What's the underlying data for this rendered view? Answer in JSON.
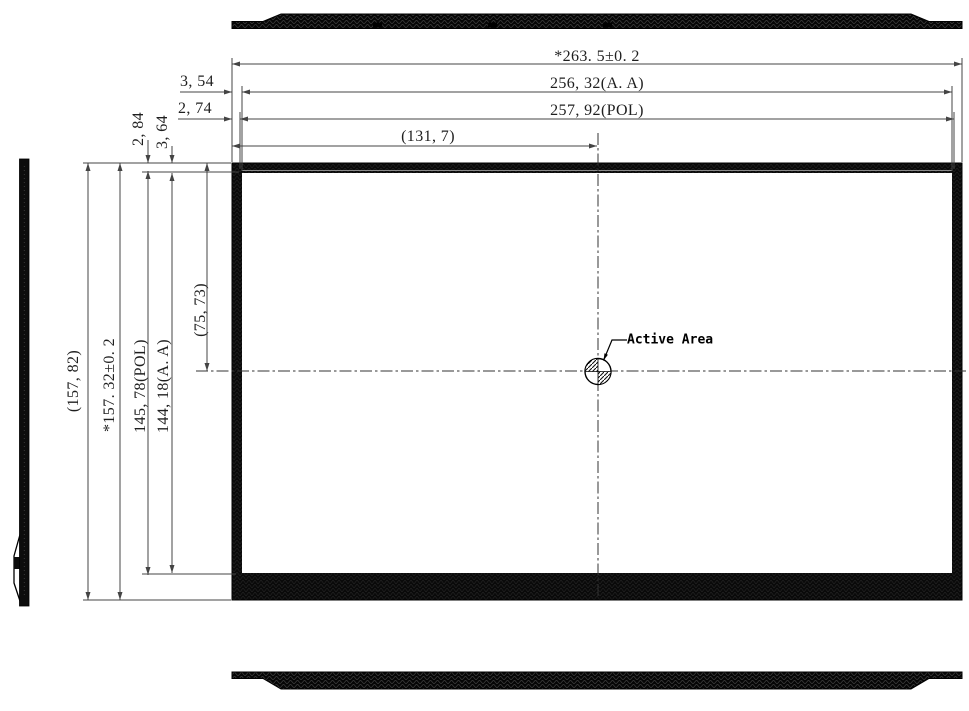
{
  "drawing": {
    "type": "lcd-panel-outline-dimension-drawing",
    "colors": {
      "object_line": "#0a0a0a",
      "dimension_line": "#444444",
      "text": "#1f1f1f"
    }
  },
  "labels": {
    "active_area": "Active Area"
  },
  "dims": {
    "overall_width": "*263. 5±0. 2",
    "aa_width": "256, 32(A. A)",
    "pol_width": "257, 92(POL)",
    "center_x": "(131, 7)",
    "edge_aa_x": "3, 54",
    "edge_pol_x": "2, 74",
    "edge_pol_y": "2, 84",
    "edge_aa_y": "3, 64",
    "overall_height_ref": "(157, 82)",
    "overall_height": "*157. 32±0. 2",
    "pol_height": "145, 78(POL)",
    "aa_height": "144, 18(A. A)",
    "center_y": "(75, 73)"
  }
}
